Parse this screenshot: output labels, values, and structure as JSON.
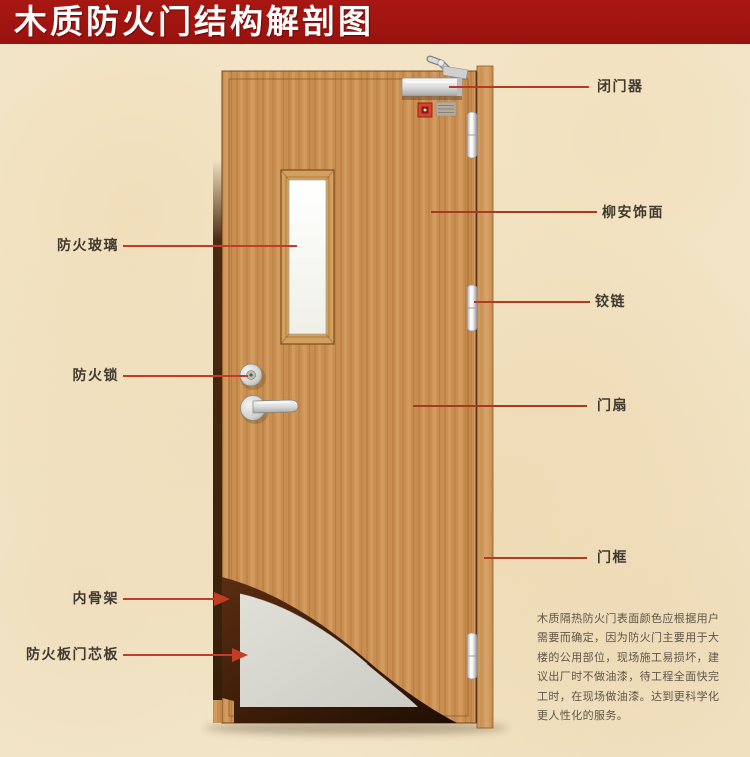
{
  "title": "木质防火门结构解剖图",
  "colors": {
    "banner": "#9e1410",
    "leader_line_left": "#c33d26",
    "leader_line_right": "#a83a24",
    "wood": "#c98f52",
    "core_board": "#d8d7d0",
    "skeleton_dark": "#3a1c08",
    "background": "#f4e9ce"
  },
  "labels": {
    "left": [
      {
        "text": "防火玻璃"
      },
      {
        "text": "防火锁"
      },
      {
        "text": "内骨架"
      },
      {
        "text": "防火板门芯板"
      }
    ],
    "right": [
      {
        "text": "闭门器"
      },
      {
        "text": "柳安饰面"
      },
      {
        "text": "铰链"
      },
      {
        "text": "门扇"
      },
      {
        "text": "门框"
      }
    ]
  },
  "description": {
    "lines": [
      "木质隔热防火门表面颜色应根据用户",
      "需要而确定，因为防火门主要用于大",
      "楼的公用部位，现场施工易损坏，建",
      "议出厂时不做油漆，待工程全面快完",
      "工时，在现场做油漆。达到更科学化",
      "更人性化的服务。"
    ]
  }
}
